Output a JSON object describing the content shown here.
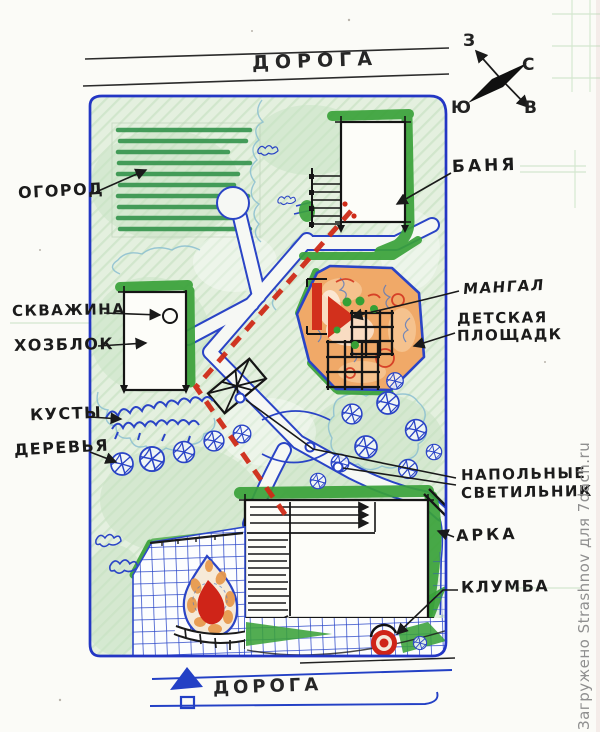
{
  "plan": {
    "road_top": "ДОРОГА",
    "road_bottom": "ДОРОГА",
    "compass": {
      "west": "З",
      "north": "С",
      "south": "Ю",
      "east": "В"
    },
    "labels": {
      "ogorod": "ОГОРОД",
      "banya": "БАНЯ",
      "skvazhina": "СКВАЖИНА",
      "hozblok": "ХОЗБЛОК",
      "kusty": "КУСТЫ",
      "derevya": "ДЕРЕВЬЯ",
      "mangal": "МАНГАЛ",
      "detskaya_1": "ДЕТСКАЯ",
      "detskaya_2": "ПЛОЩАДК",
      "svetilniki_1": "НАПОЛЬНЫЕ",
      "svetilniki_2": "СВЕТИЛЬНИК",
      "arka": "АРКА",
      "klumba": "КЛУМБА"
    },
    "colors": {
      "plot_outline_blue": "#2336c4",
      "lawn_green": "#e4f0df",
      "hedge_green": "#3aa23a",
      "garden_row_green": "#2f9148",
      "playground_sand": "#f0a968",
      "accent_red": "#cf2a17",
      "ink_black": "#1a1a1a",
      "paving_grid_blue": "#2d49c9",
      "watermark_gray": "#8f8f8f"
    },
    "watermark": "Загружено Strashnov для 7dach.ru"
  }
}
